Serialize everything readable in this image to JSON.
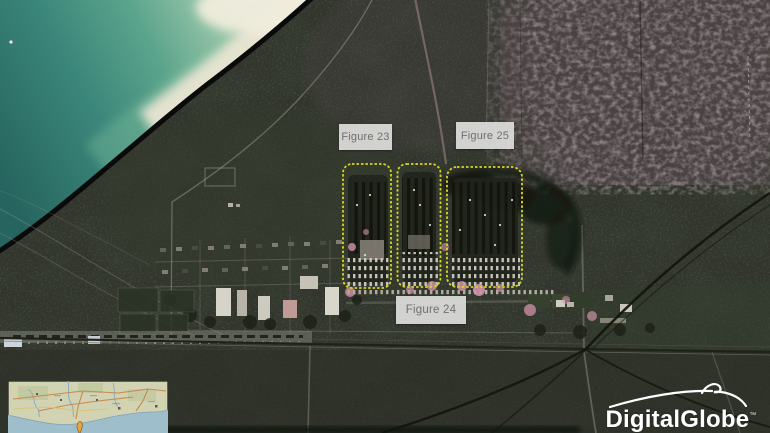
{
  "annotations": {
    "figure_23": {
      "label": "Figure 23"
    },
    "figure_24": {
      "label": "Figure 24"
    },
    "figure_25": {
      "label": "Figure 25"
    }
  },
  "branding": {
    "logo_text": "DigitalGlobe",
    "trademark_symbol": "™"
  },
  "colors": {
    "annotation_accent": "#d6d620",
    "label_background": "#dadad8",
    "label_text": "#6f6f6f",
    "sea_deep": "#26655f",
    "sea_shallow": "#8ec0a4",
    "sand": "#e8e4d0",
    "coastline": "#0a0a0a",
    "land_base": "#31352c",
    "terrain_pink": "#5c4c53",
    "logo": "#ffffff",
    "inset_land": "#d2d3b2",
    "inset_water": "#9fbecb",
    "inset_marker": "#e8a43c"
  }
}
